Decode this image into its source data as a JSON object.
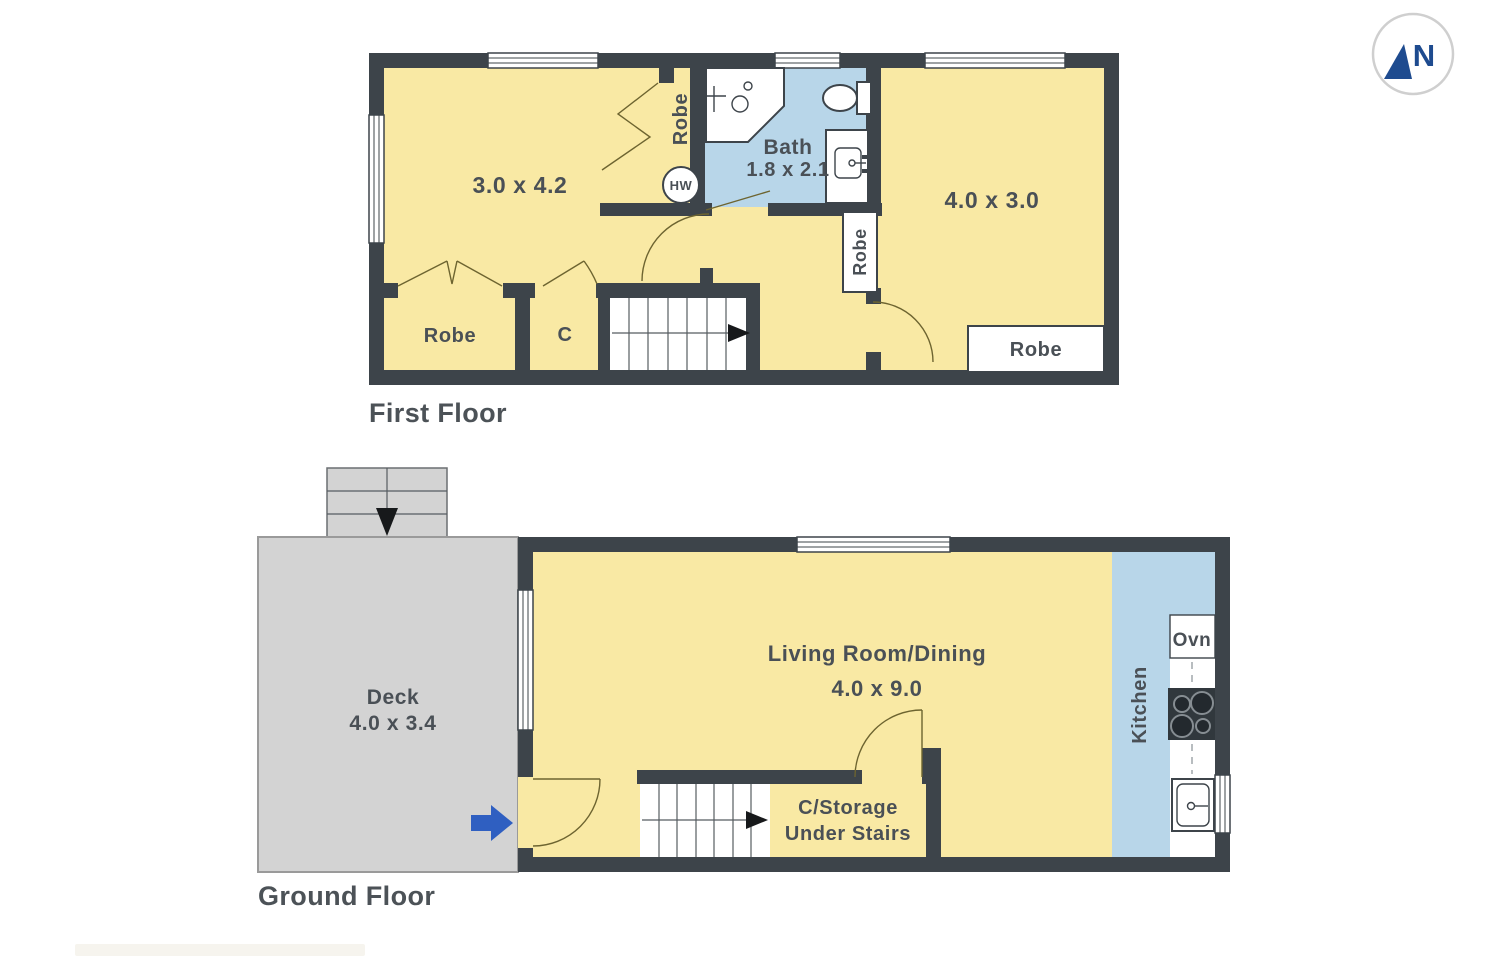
{
  "compass": {
    "letter": "N"
  },
  "colors": {
    "wall": "#3d444a",
    "floor-yellow": "#f9e9a4",
    "floor-blue": "#b8d6e9",
    "deck-gray": "#d3d3d3",
    "label": "#4a5056",
    "title": "#4c5257",
    "arrow-blue": "#2f5fc1",
    "compass-navy": "#1e4b8f"
  },
  "first_floor": {
    "title": "First Floor",
    "bedroom1_dims": "3.0 x 4.2",
    "bedroom2_dims": "4.0 x 3.0",
    "bath_name": "Bath",
    "bath_dims": "1.8 x 2.1",
    "robe_recess_label": "Robe",
    "robe_niche_label": "Robe",
    "robe_room_label": "Robe",
    "closet_label": "C",
    "bedroom2_robe_label": "Robe",
    "hot_water_label": "HW"
  },
  "ground_floor": {
    "title": "Ground Floor",
    "living_name": "Living Room/Dining",
    "living_dims": "4.0 x 9.0",
    "deck_name": "Deck",
    "deck_dims": "4.0 x 3.4",
    "kitchen_label": "Kitchen",
    "oven_label": "Ovn",
    "storage_label_line1": "C/Storage",
    "storage_label_line2": "Under Stairs"
  }
}
